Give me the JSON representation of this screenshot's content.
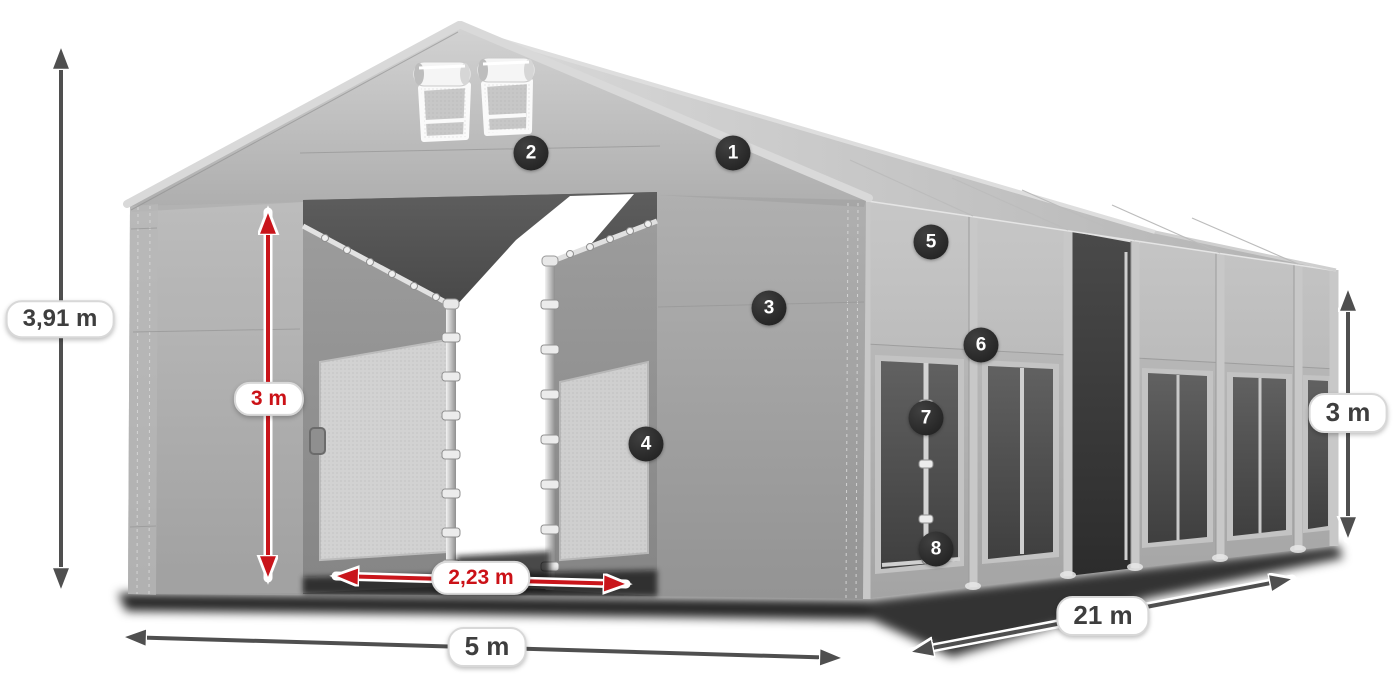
{
  "figure": {
    "type": "dimensioned product diagram",
    "subject": "PVC storage tent / marquee with open front entrance, numbered feature callouts and size arrows",
    "background_color": "#ffffff"
  },
  "dimensions": {
    "total_height": {
      "value": "3,91 m",
      "style": "dark",
      "axis": "vertical",
      "position": "left of tent"
    },
    "entrance_height": {
      "value": "3 m",
      "style": "red",
      "axis": "vertical",
      "position": "front entrance"
    },
    "entrance_width": {
      "value": "2,23 m",
      "style": "red",
      "axis": "horizontal",
      "position": "front entrance bottom"
    },
    "front_width": {
      "value": "5 m",
      "style": "dark",
      "axis": "horizontal",
      "position": "front bottom"
    },
    "side_length": {
      "value": "21 m",
      "style": "dark",
      "axis": "diagonal",
      "position": "side bottom"
    },
    "side_height": {
      "value": "3 m",
      "style": "dark",
      "axis": "vertical",
      "position": "right of tent"
    }
  },
  "callouts": [
    {
      "number": "1",
      "points_at": "roof slope"
    },
    {
      "number": "2",
      "points_at": "front gable panel above entrance"
    },
    {
      "number": "3",
      "points_at": "front wall panel"
    },
    {
      "number": "4",
      "points_at": "entrance side frame"
    },
    {
      "number": "5",
      "points_at": "side wall upper panel"
    },
    {
      "number": "6",
      "points_at": "side wall rail joint"
    },
    {
      "number": "7",
      "points_at": "window frame pole"
    },
    {
      "number": "8",
      "points_at": "ground frame bar"
    }
  ],
  "colors": {
    "arrow_dark": "#4f4f4f",
    "arrow_red": "#c9151b",
    "label_text_dark": "#3e3e3e",
    "label_text_red": "#cb1117",
    "label_background": "#ffffff",
    "label_border": "#d6d6d6",
    "callout_background": "#262626",
    "callout_text": "#ffffff",
    "tent_light_gray": "#c8c8c8",
    "tent_mid_gray": "#a8a8a8",
    "tent_dark_opening": "#4a4a4a"
  }
}
